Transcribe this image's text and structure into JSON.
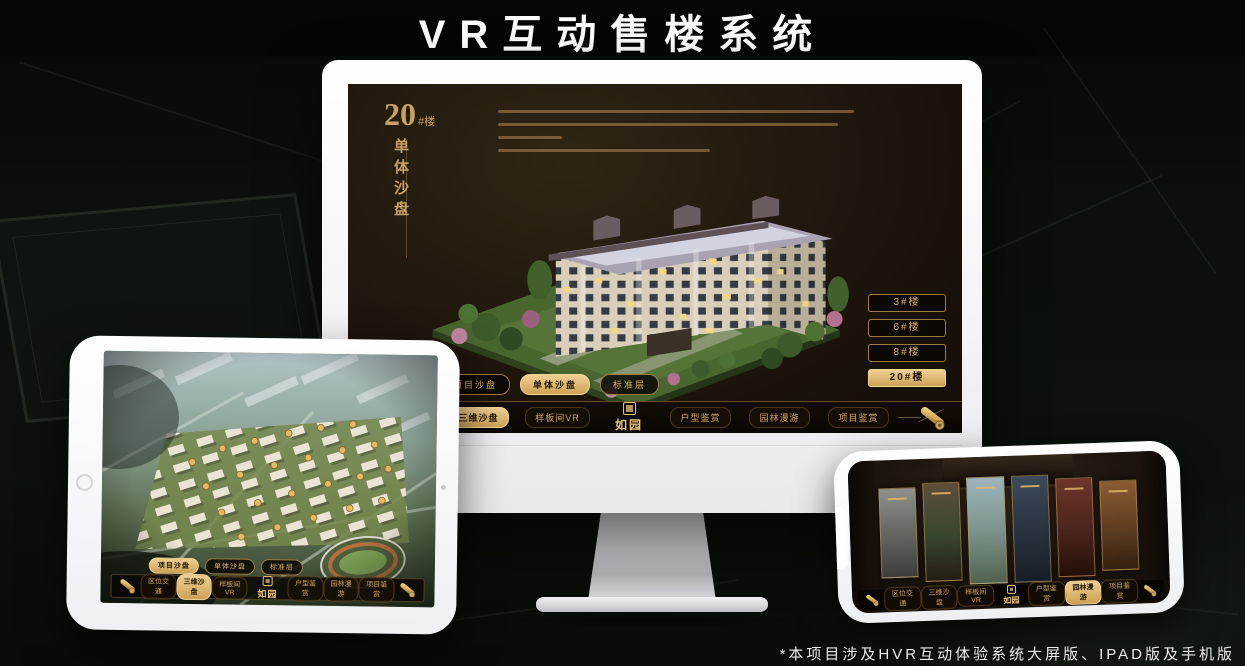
{
  "page": {
    "title": "VR互动售楼系统",
    "footnote": "*本项目涉及HVR互动体验系统大屏版、IPAD版及手机版"
  },
  "colors": {
    "gold": "#c9a25c",
    "gold_bright": "#eed092",
    "gold_deep": "#9c7b40",
    "screen_bg": "#1e150c",
    "page_bg": "#0b100c",
    "device_frame": "#ffffff"
  },
  "monitor_ui": {
    "unit_number": "20",
    "unit_suffix": "#楼",
    "unit_subtitle": "单体沙盘",
    "tabs": [
      "项目沙盘",
      "单体沙盘",
      "标准层"
    ],
    "active_tab": "单体沙盘",
    "building_buttons": [
      "3#楼",
      "6#楼",
      "8#楼",
      "20#楼"
    ],
    "active_building": "20#楼",
    "nav_left": [
      "区位交通",
      "三维沙盘",
      "样板间VR"
    ],
    "nav_right": [
      "户型鉴赏",
      "园林漫游",
      "项目鉴赏"
    ],
    "active_nav": "三维沙盘",
    "logo": "如园"
  },
  "tablet_ui": {
    "tabs": [
      "项目沙盘",
      "单体沙盘",
      "标准层"
    ],
    "active_tab": "项目沙盘",
    "nav_left": [
      "区位交通",
      "三维沙盘",
      "样板间VR"
    ],
    "nav_right": [
      "户型鉴赏",
      "园林漫游",
      "项目鉴赏"
    ],
    "active_nav": "三维沙盘",
    "logo": "如园"
  },
  "phone_ui": {
    "nav_left": [
      "区位交通",
      "三维沙盘",
      "样板间VR"
    ],
    "nav_right": [
      "户型鉴赏",
      "园林漫游",
      "项目鉴赏"
    ],
    "active_nav": "园林漫游",
    "logo": "如园"
  },
  "icons": {
    "nav_end": "scroll-icon",
    "logo_seal": "seal-icon"
  }
}
